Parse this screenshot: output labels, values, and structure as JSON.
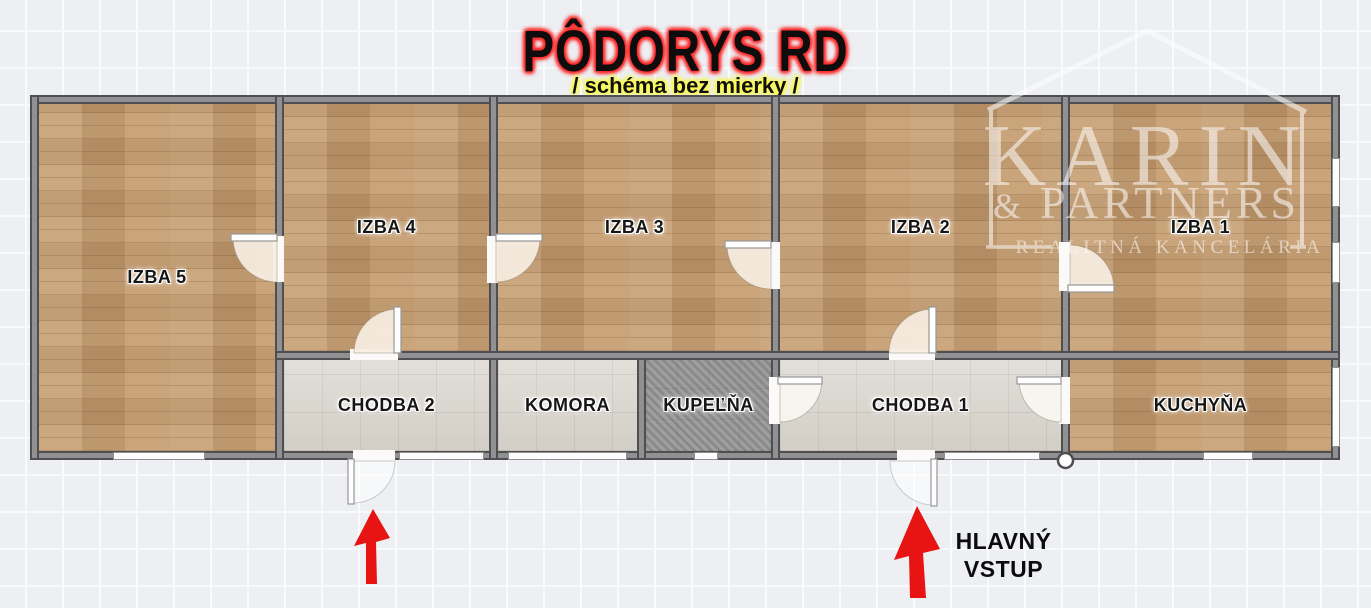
{
  "header": {
    "title": "PÔDORYS RD",
    "subtitle": "/ schéma bez mierky /"
  },
  "rooms": {
    "izba5": "IZBA 5",
    "izba4": "IZBA 4",
    "izba3": "IZBA 3",
    "izba2": "IZBA 2",
    "izba1": "IZBA 1",
    "chodba2": "CHODBA 2",
    "komora": "KOMORA",
    "kupelna": "KUPEĽŇA",
    "chodba1": "CHODBA 1",
    "kuchyna": "KUCHYŇA"
  },
  "annotations": {
    "entrance_line1": "HLAVNÝ",
    "entrance_line2": "VSTUP"
  },
  "watermark": {
    "name": "KARIN",
    "amp": "&",
    "partners": "PARTNERS",
    "tagline": "REALITNÁ KANCELÁRIA"
  },
  "colors": {
    "title_text": "#0d0d0d",
    "title_glow": "#ff2020",
    "subtitle_glow": "#ffff4d",
    "arrow_red": "#e81414",
    "wall_fill": "#919193",
    "wall_edge": "#4f4f51",
    "wood_floor": "#c49a6c",
    "hall_floor": "#d9d5cd",
    "bath_floor": "#949494"
  }
}
